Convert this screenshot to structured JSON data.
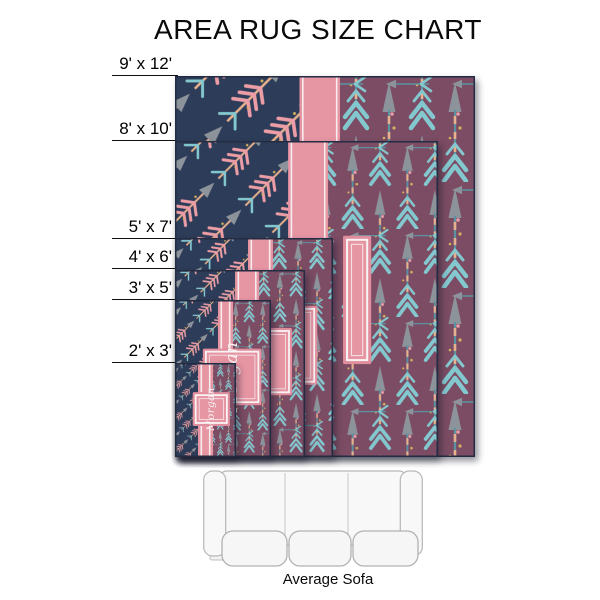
{
  "title": "AREA RUG SIZE CHART",
  "sofa": {
    "label": "Average Sofa"
  },
  "monogram_text": "Morgan",
  "colors": {
    "navy": "#2d3c58",
    "plum": "#7b4c63",
    "pink_band": "#e695a3",
    "pink_deep": "#e08e9d",
    "white_trim": "#f9f3f4",
    "teal": "#84c8cf",
    "teal_dark": "#5b93a2",
    "arrow_gray": "#8d939b",
    "peach": "#e7b18d",
    "gold": "#d6b05e",
    "pink_feather": "#ec9da6",
    "outline": "#232c42",
    "sofa_stroke": "#b7b7b7",
    "sofa_fill": "#f8f8f8"
  },
  "design": {
    "frame_rel": {
      "x": 0.639,
      "y": 0.3,
      "w": 0.107,
      "h": 0.406
    },
    "square_rel": {
      "x": 0.29,
      "y": 0.31,
      "w": 0.61,
      "h": 0.36
    }
  },
  "rugs": [
    {
      "id": "9x12",
      "label": "9' x 12'",
      "x": 175,
      "y": 76,
      "w": 300,
      "h": 381,
      "band_left": 0.415,
      "band_width": 0.135,
      "line_y": 75,
      "pattern_scale": 1.0,
      "has_frame": true,
      "has_square": false
    },
    {
      "id": "8x10",
      "label": "8' x 10'",
      "x": 175,
      "y": 141,
      "w": 263,
      "h": 316,
      "band_left": 0.43,
      "band_width": 0.152,
      "line_y": 140,
      "pattern_scale": 0.83,
      "has_frame": true,
      "has_square": false
    },
    {
      "id": "5x7",
      "label": "5' x 7'",
      "x": 175,
      "y": 238,
      "w": 158,
      "h": 219,
      "band_left": 0.462,
      "band_width": 0.158,
      "line_y": 238,
      "pattern_scale": 0.575,
      "has_frame": false,
      "has_square": true
    },
    {
      "id": "4x6",
      "label": "4' x 6'",
      "x": 175,
      "y": 270,
      "w": 130,
      "h": 187,
      "band_left": 0.462,
      "band_width": 0.185,
      "line_y": 268,
      "pattern_scale": 0.49,
      "has_frame": false,
      "has_square": true
    },
    {
      "id": "3x5",
      "label": "3' x 5'",
      "x": 175,
      "y": 300,
      "w": 96,
      "h": 157,
      "band_left": 0.448,
      "band_width": 0.156,
      "line_y": 299,
      "pattern_scale": 0.41,
      "has_frame": false,
      "has_square": true
    },
    {
      "id": "2x3",
      "label": "2' x 3'",
      "x": 175,
      "y": 363,
      "w": 61,
      "h": 94,
      "band_left": 0.377,
      "band_width": 0.246,
      "line_y": 362,
      "pattern_scale": 0.25,
      "has_frame": false,
      "has_square": true
    }
  ]
}
